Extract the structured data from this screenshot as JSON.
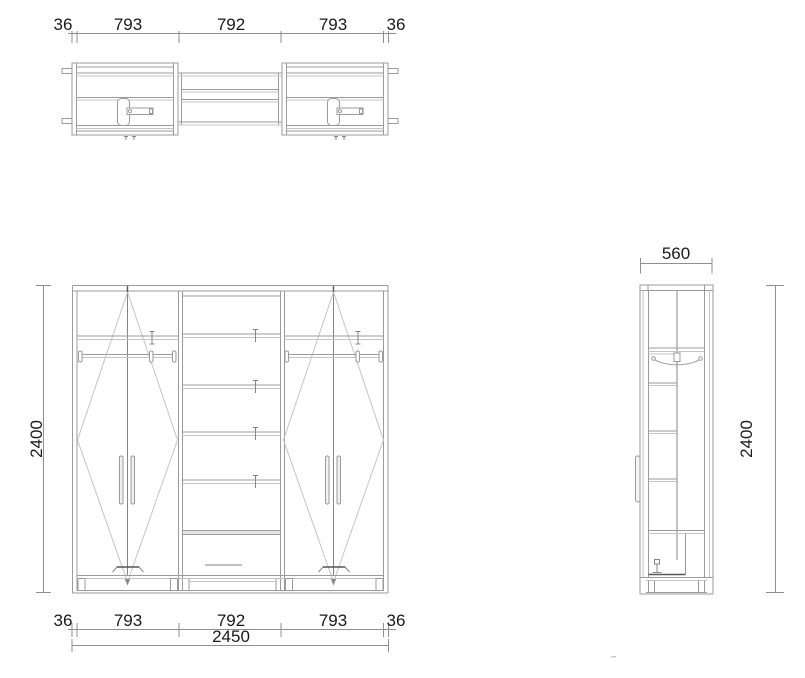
{
  "drawing_title": "Wardrobe technical drawing - plan, front and side views",
  "colors": {
    "background": "#ffffff",
    "lines": "#9b9b9b",
    "dark_lines": "#555555",
    "text": "#1a1a1a"
  },
  "plan_view": {
    "dimension_segments": [
      "36",
      "793",
      "792",
      "793",
      "36"
    ]
  },
  "front_view": {
    "height": "2400",
    "dimension_segments": [
      "36",
      "793",
      "792",
      "793",
      "36"
    ],
    "total_width": "2450"
  },
  "side_view": {
    "width": "560",
    "height": "2400"
  }
}
